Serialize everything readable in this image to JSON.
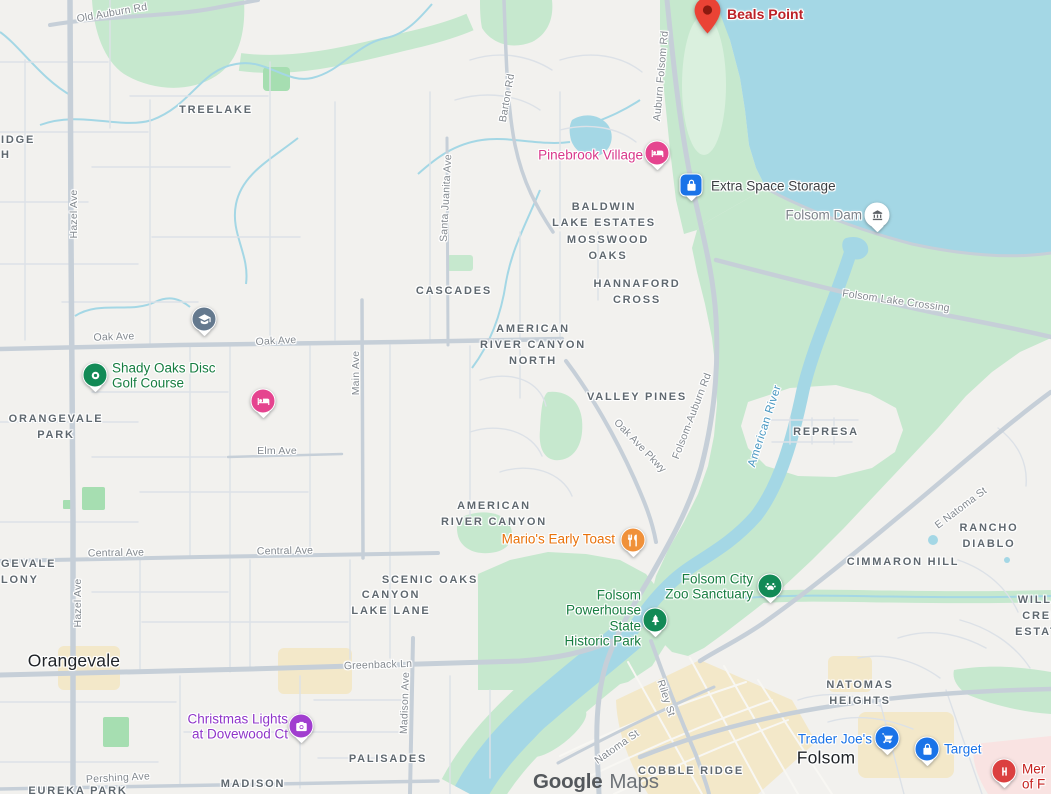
{
  "app": {
    "name": "Google Maps",
    "attribution": {
      "brand": "Google",
      "product": "Maps"
    }
  },
  "colors": {
    "bg": "#f2f1ee",
    "water": "#a4d7e5",
    "park": "#c6e8ce",
    "parkLight": "#daf0de",
    "parkSmall": "#a6deb1",
    "urban": "#f3e8c9",
    "hospitalArea": "#f9e3e2",
    "roadMinor": "#dce1e7",
    "roadMajor": "#c6cfd8",
    "roadWhite": "#f8f7f3",
    "labelGray": "#5f686f",
    "cityLabel": "#202428",
    "roadLabel": "#83898f",
    "waterLabel": "#4796c0",
    "poiGreen": "#177d41",
    "poiBlue": "#1a73e8",
    "poiOrange": "#e8710a",
    "poiPink": "#d9388b",
    "poiPurple": "#8f35c9",
    "poiRed": "#bc2127",
    "poiDark": "#3c4043",
    "poiGray": "#7d838a"
  },
  "map": {
    "cities": [
      {
        "text": "Orangevale",
        "x": 74,
        "y": 661
      },
      {
        "text": "Folsom",
        "x": 826,
        "y": 758
      }
    ],
    "neighborhoods": [
      {
        "text": "TREELAKE",
        "x": 216,
        "y": 111
      },
      {
        "text": "BALDWIN\nLAKE ESTATES",
        "x": 604,
        "y": 216
      },
      {
        "text": "MOSSWOOD\nOAKS",
        "x": 608,
        "y": 249
      },
      {
        "text": "HANNAFORD\nCROSS",
        "x": 637,
        "y": 293
      },
      {
        "text": "CASCADES",
        "x": 454,
        "y": 292
      },
      {
        "text": "AMERICAN\nRIVER CANYON\nNORTH",
        "x": 533,
        "y": 346
      },
      {
        "text": "VALLEY PINES",
        "x": 637,
        "y": 398
      },
      {
        "text": "AMERICAN\nRIVER CANYON",
        "x": 494,
        "y": 515
      },
      {
        "text": "SCENIC OAKS",
        "x": 430,
        "y": 581
      },
      {
        "text": "CANYON\nLAKE LANE",
        "x": 391,
        "y": 604
      },
      {
        "text": "REPRESA",
        "x": 826,
        "y": 433
      },
      {
        "text": "CIMMARON HILL",
        "x": 903,
        "y": 563
      },
      {
        "text": "RANCHO DIABLO",
        "x": 989,
        "y": 537
      },
      {
        "text": "WILLOW\nCREEK ESTATES",
        "x": 1046,
        "y": 617
      },
      {
        "text": "NATOMAS\nHEIGHTS",
        "x": 860,
        "y": 694
      },
      {
        "text": "COBBLE RIDGE",
        "x": 691,
        "y": 772
      },
      {
        "text": "PALISADES",
        "x": 388,
        "y": 760
      },
      {
        "text": "MADISON",
        "x": 253,
        "y": 785
      },
      {
        "text": "ORANGEVALE\nPARK",
        "x": 56,
        "y": 428
      },
      {
        "text": "GEVALE\nLONY",
        "x": 1,
        "y": 573,
        "align": "left"
      },
      {
        "text": "IDGE",
        "x": 1,
        "y": 141,
        "align": "left"
      },
      {
        "text": "H",
        "x": 1,
        "y": 156,
        "align": "left"
      },
      {
        "text": "EUREKA PARK",
        "x": 78,
        "y": 792
      }
    ],
    "road_labels": [
      {
        "text": "Old Auburn Rd",
        "x": 112,
        "y": 13,
        "r": -10
      },
      {
        "text": "Hazel Ave",
        "x": 74,
        "y": 214,
        "r": -90
      },
      {
        "text": "Hazel Ave",
        "x": 78,
        "y": 603,
        "r": -90
      },
      {
        "text": "Oak Ave",
        "x": 114,
        "y": 337,
        "r": -2
      },
      {
        "text": "Oak Ave",
        "x": 276,
        "y": 341,
        "r": -3
      },
      {
        "text": "Main Ave",
        "x": 356,
        "y": 373,
        "r": -90
      },
      {
        "text": "Elm Ave",
        "x": 277,
        "y": 451,
        "r": 0
      },
      {
        "text": "Central Ave",
        "x": 116,
        "y": 553,
        "r": -1
      },
      {
        "text": "Central Ave",
        "x": 285,
        "y": 551,
        "r": -1
      },
      {
        "text": "Greenback Ln",
        "x": 378,
        "y": 665,
        "r": -2
      },
      {
        "text": "Madison Ave",
        "x": 405,
        "y": 703,
        "r": -88
      },
      {
        "text": "Pershing Ave",
        "x": 118,
        "y": 778,
        "r": -3
      },
      {
        "text": "Barton Rd",
        "x": 507,
        "y": 98,
        "r": -80
      },
      {
        "text": "Santa Juanita Ave",
        "x": 446,
        "y": 198,
        "r": -87
      },
      {
        "text": "Auburn Folsom Rd",
        "x": 661,
        "y": 76,
        "r": -85
      },
      {
        "text": "Folsom-Auburn Rd",
        "x": 692,
        "y": 416,
        "r": -69
      },
      {
        "text": "Oak Ave Pkwy",
        "x": 640,
        "y": 446,
        "r": 46
      },
      {
        "text": "Folsom Lake Crossing",
        "x": 896,
        "y": 301,
        "r": 8
      },
      {
        "text": "E Natoma St",
        "x": 961,
        "y": 508,
        "r": -37
      },
      {
        "text": "Riley St",
        "x": 666,
        "y": 698,
        "r": 72
      },
      {
        "text": "Natoma St",
        "x": 617,
        "y": 747,
        "r": -35
      }
    ],
    "water_labels": [
      {
        "text": "American River",
        "x": 765,
        "y": 426,
        "r": -72
      }
    ],
    "pois": [
      {
        "id": "beals-point",
        "marker": true,
        "pin": {
          "x": 694,
          "y": -3,
          "color": "#ea4335",
          "glyph": "map-pin"
        },
        "label": {
          "text": "Beals Point",
          "x": 727,
          "y": 15,
          "align": "left",
          "color": "#bc2127",
          "size": 14,
          "weight": 700
        }
      },
      {
        "id": "pinebrook-village",
        "pin": {
          "shape": "circle",
          "x": 657,
          "y": 153,
          "color": "#e5448f",
          "glyph": "bed"
        },
        "label": {
          "text": "Pinebrook Village",
          "x": 643,
          "y": 155,
          "align": "right",
          "color": "#d9388b"
        }
      },
      {
        "id": "extra-space-storage",
        "pin": {
          "shape": "square",
          "x": 691,
          "y": 185,
          "color": "#1a73e8",
          "glyph": "lock"
        },
        "label": {
          "text": "Extra Space Storage",
          "x": 711,
          "y": 186,
          "align": "left",
          "color": "#3c4043",
          "weight": 400
        }
      },
      {
        "id": "folsom-dam",
        "pin": {
          "shape": "circle",
          "x": 877,
          "y": 215,
          "color": "#ffffff",
          "glyph": "monument",
          "glyphColor": "#5f6368"
        },
        "label": {
          "text": "Folsom Dam",
          "x": 862,
          "y": 215,
          "align": "right",
          "color": "#7d838a",
          "weight": 400
        }
      },
      {
        "id": "shady-oaks-disc-golf-course",
        "pin": {
          "shape": "circle",
          "x": 95,
          "y": 375,
          "color": "#128a56",
          "glyph": "disc"
        },
        "label": {
          "text": "Shady Oaks Disc\nGolf Course",
          "x": 112,
          "y": 376,
          "align": "left",
          "color": "#177d41"
        }
      },
      {
        "id": "marios-early-toast",
        "pin": {
          "shape": "circle",
          "x": 633,
          "y": 540,
          "color": "#f0913a",
          "glyph": "restaurant"
        },
        "label": {
          "text": "Mario's Early Toast",
          "x": 615,
          "y": 539,
          "align": "right",
          "color": "#e8710a"
        }
      },
      {
        "id": "folsom-city-zoo-sanctuary",
        "pin": {
          "shape": "circle",
          "x": 770,
          "y": 586,
          "color": "#128a56",
          "glyph": "paw"
        },
        "label": {
          "text": "Folsom City\nZoo Sanctuary",
          "x": 753,
          "y": 587,
          "align": "right",
          "color": "#177d41"
        }
      },
      {
        "id": "folsom-powerhouse-state-historic-park",
        "pin": {
          "shape": "circle",
          "x": 655,
          "y": 620,
          "color": "#128a56",
          "glyph": "tree"
        },
        "label": {
          "text": "Folsom\nPowerhouse\nState\nHistoric Park",
          "x": 641,
          "y": 618,
          "align": "right",
          "color": "#177d41"
        }
      },
      {
        "id": "christmas-lights-at-dovewood-ct",
        "pin": {
          "shape": "circle",
          "x": 301,
          "y": 726,
          "color": "#a13ecf",
          "glyph": "camera"
        },
        "label": {
          "text": "Christmas Lights\nat Dovewood Ct",
          "x": 288,
          "y": 727,
          "align": "right",
          "color": "#8f35c9"
        }
      },
      {
        "id": "trader-joes",
        "pin": {
          "shape": "circle",
          "x": 887,
          "y": 738,
          "color": "#1a73e8",
          "glyph": "shopping-cart"
        },
        "label": {
          "text": "Trader Joe's",
          "x": 872,
          "y": 739,
          "align": "right",
          "color": "#1a73e8"
        }
      },
      {
        "id": "target",
        "pin": {
          "shape": "circle",
          "x": 927,
          "y": 749,
          "color": "#1a73e8",
          "glyph": "lock"
        },
        "label": {
          "text": "Target",
          "x": 944,
          "y": 749,
          "align": "left",
          "color": "#1a73e8"
        }
      },
      {
        "id": "mercy-hospital",
        "pin": {
          "shape": "circle",
          "x": 1004,
          "y": 771,
          "color": "#db4040",
          "glyph": "hospital-h"
        },
        "label": {
          "text": "Mer\nof F",
          "x": 1022,
          "y": 777,
          "align": "left",
          "color": "#c5221f"
        }
      }
    ],
    "standalone_pins": [
      {
        "id": "school",
        "x": 204,
        "y": 319,
        "color": "#64798e",
        "glyph": "graduation-cap"
      },
      {
        "id": "lodging",
        "x": 263,
        "y": 401,
        "color": "#e5448f",
        "glyph": "bed"
      }
    ]
  }
}
